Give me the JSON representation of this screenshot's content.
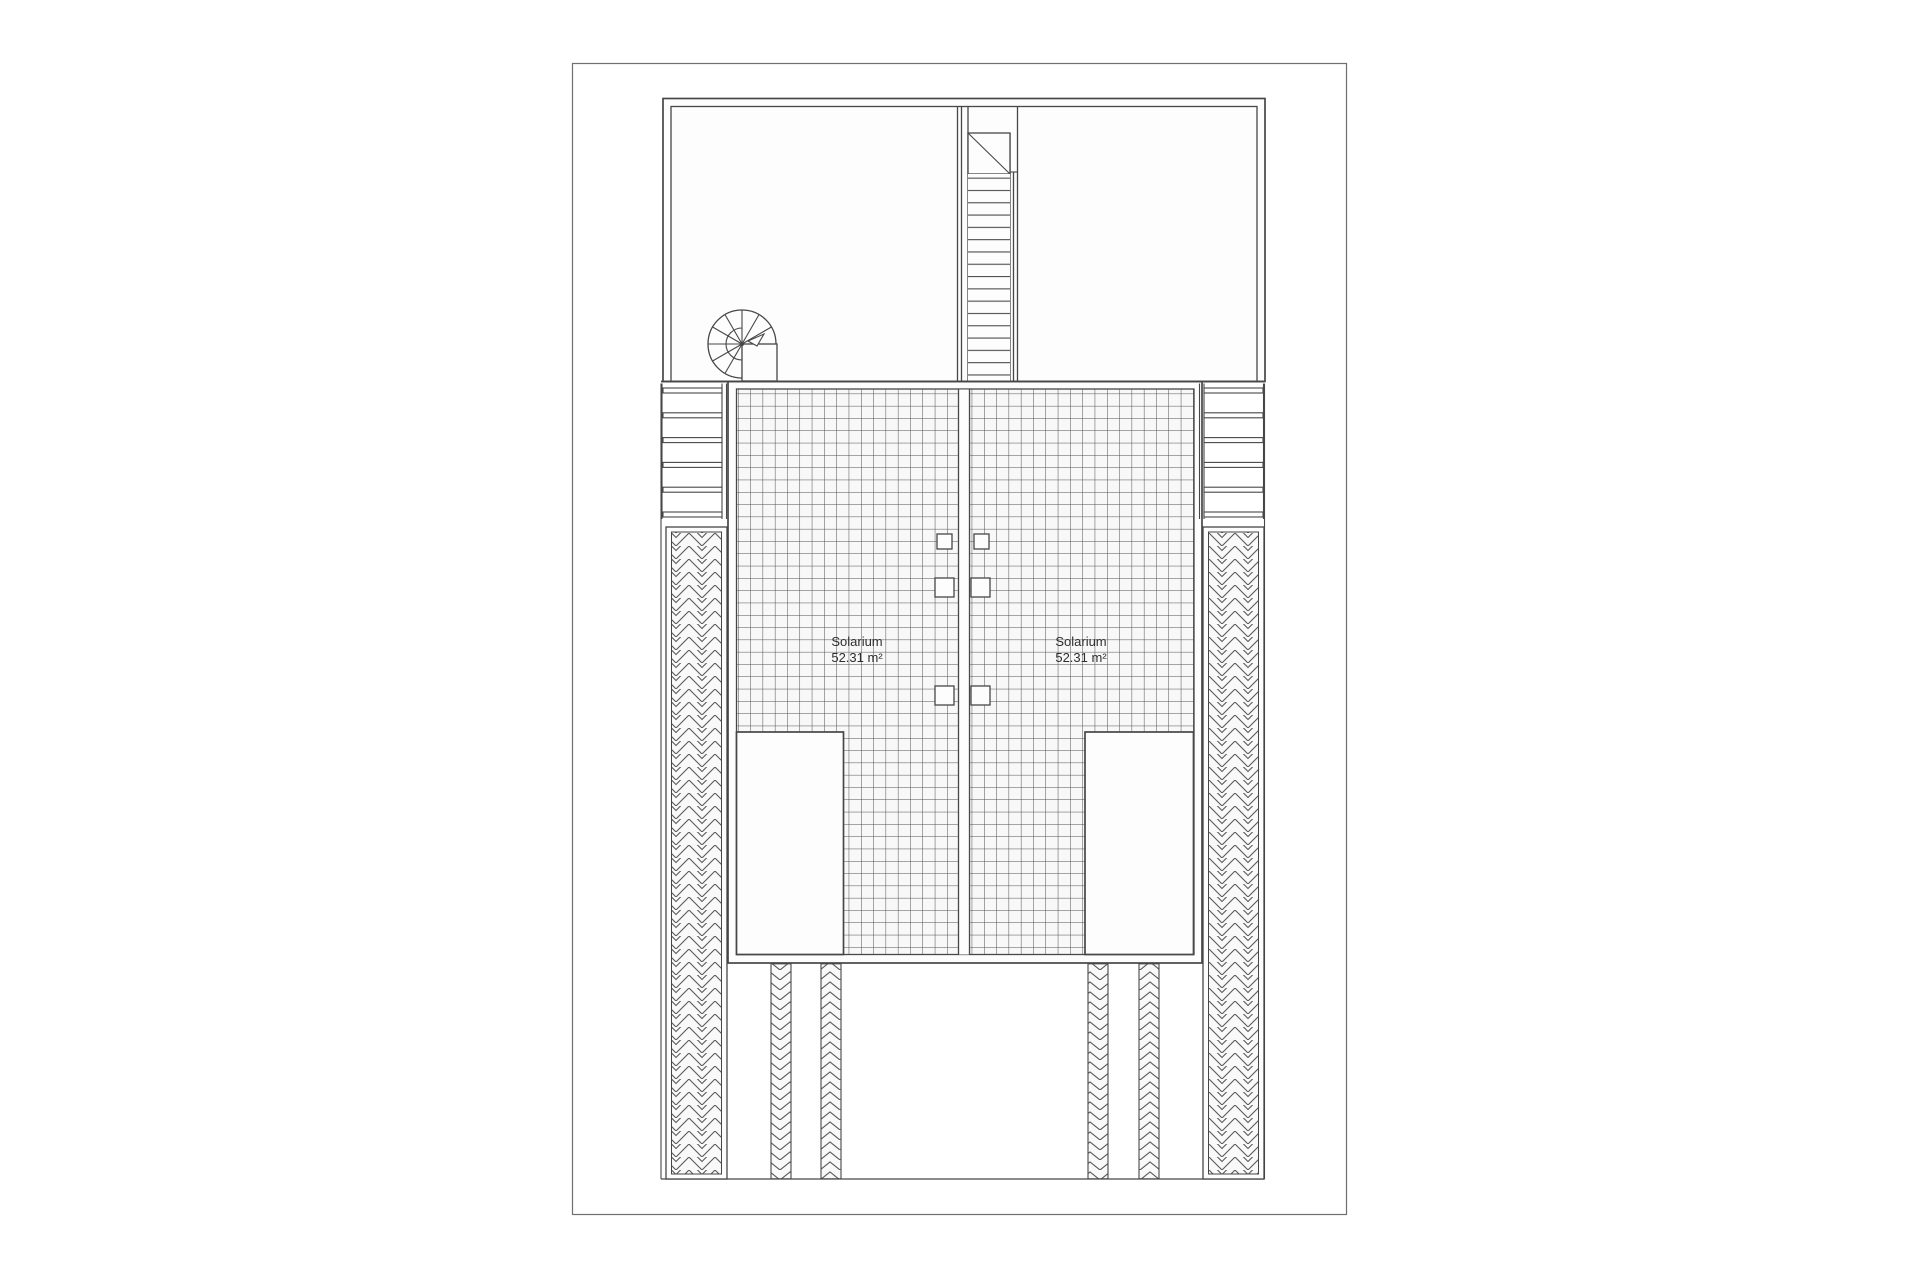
{
  "sheet": {
    "kind": "architectural floor plan — solarium / roof level",
    "background_color": "#ffffff",
    "border_color": "#6f6f6f",
    "line_color": "#474747",
    "hatch_fill_color": "#f8f8f8"
  },
  "plan": {
    "units": [
      {
        "id": "left",
        "room_label": "Solarium",
        "room_area": "52.31 m²"
      },
      {
        "id": "right",
        "room_label": "Solarium",
        "room_area": "52.31 m²"
      }
    ],
    "features": [
      "upper-rooms",
      "straight-staircase",
      "spiral-staircase",
      "tiled-terraces",
      "railings",
      "herringbone-paving-strips",
      "white-roof-openings",
      "chevron-pillar-strips"
    ]
  }
}
